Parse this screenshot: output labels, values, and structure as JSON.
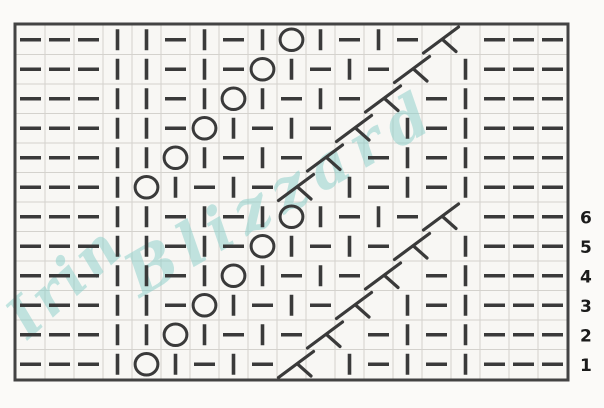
{
  "chart": {
    "title": "lace-knitting-stitch-chart",
    "columns": 19,
    "cell_width": 29.0,
    "cell_height": 29.5,
    "origin_x": 16,
    "origin_y": 25,
    "rows": [
      {
        "cells": "PPPKKPKPKOKPKPD_PPP",
        "label": ""
      },
      {
        "cells": "PPPKKPKPOKPKPD_KPPP",
        "label": ""
      },
      {
        "cells": "PPPKKPKOKPKPD_PKPPP",
        "label": ""
      },
      {
        "cells": "PPPKKPOKPKPD_KPKPPP",
        "label": ""
      },
      {
        "cells": "PPPKKOKPKPD_PKPKPPP",
        "label": ""
      },
      {
        "cells": "PPPKOKPKPD_KPKPKPPP",
        "label": ""
      },
      {
        "cells": "PPPKKPKPKOKPKPD_PPP",
        "label": "6"
      },
      {
        "cells": "PPPKKPKPOKPKPD_KPPP",
        "label": "5"
      },
      {
        "cells": "PPPKKPKOKPKPD_PKPPP",
        "label": "4"
      },
      {
        "cells": "PPPKKPOKPKPD_KPKPPP",
        "label": "3"
      },
      {
        "cells": "PPPKKOKPKPD_PKPKPPP",
        "label": "2"
      },
      {
        "cells": "PPPKOKPKPD_KPKPKPPP",
        "label": "1"
      }
    ],
    "row_labels_bottom_to_top": [
      "1",
      "2",
      "3",
      "4",
      "5",
      "6"
    ],
    "symbols": {
      "P": "purl-dash",
      "K": "knit-bar",
      "O": "yarn-over-circle",
      "D": "left-leaning-decrease",
      "_": "decrease-continuation"
    },
    "colors": {
      "symbol": "#3a3a3a",
      "grid": "#d4d2cd",
      "border": "#434343",
      "chart_bg": "#f8f7f4",
      "page_bg": "#fbfaf8",
      "label": "#1b1b1b"
    }
  },
  "watermark": {
    "line1": "Irin",
    "line2": "Blizzard",
    "color": "#89cfca"
  }
}
